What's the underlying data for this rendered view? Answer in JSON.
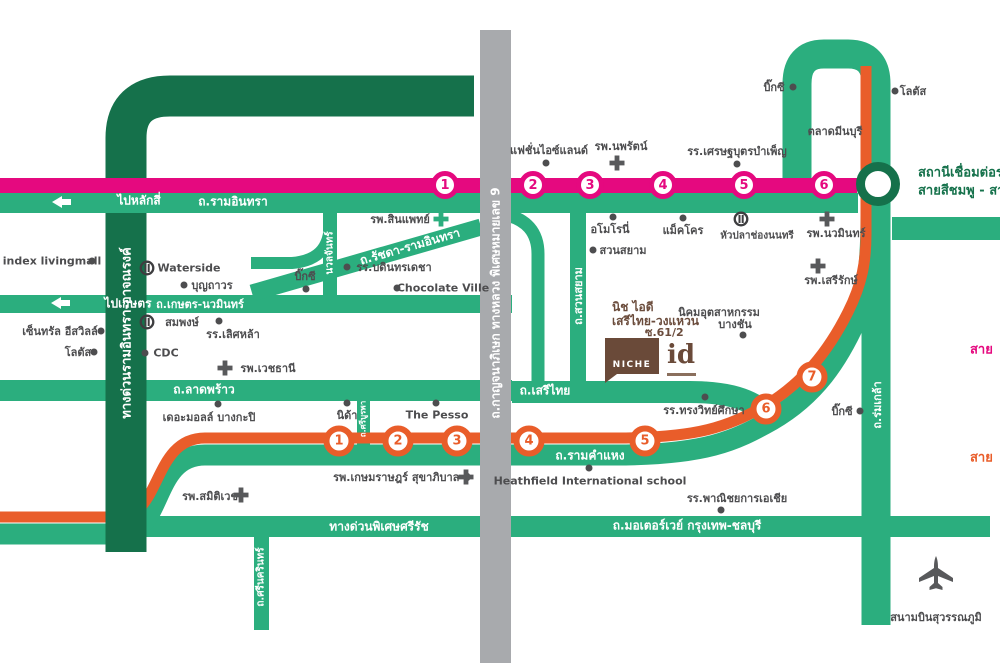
{
  "roads": {
    "ramindra": "ถ.รามอินทรา",
    "to_laksi": "ไปหลักสี่",
    "to_kaset": "ไปเกษตร",
    "kaset_nawamin": "ถ.เกษตร-นวมินทร์",
    "ratchada_ramindra": "ถ.รัชดา-รามอินทรา",
    "nuanchan": "นวลจันทร์",
    "ladprao": "ถ.ลาดพร้าว",
    "serithai": "ถ.เสรีไทย",
    "ramkhamhaeng": "ถ.รามคำแหง",
    "suan_siam": "ถ.สวนสยาม",
    "sri_burapha": "ถ.ศรีบูรพา",
    "kanchanaphisek": "ถ.กาญจนาภิเษก ทางหลวง พิเศษหมายเลข 9",
    "ramindra_expressway": "ทางด่วนรามอินทรา-อาจณรงค์",
    "sirat_expressway": "ทางด่วนพิเศษศรีรัช",
    "motorway": "ถ.มอเตอร์เวย์ กรุงเทพ-ชลบุรี",
    "srinagarindra": "ถ.ศรีนครินทร์",
    "romklao": "ถ.ร่มเกล้า"
  },
  "stations": {
    "pink": [
      "1",
      "2",
      "3",
      "4",
      "5",
      "6"
    ],
    "orange": [
      "1",
      "2",
      "3",
      "4",
      "5",
      "6",
      "7"
    ]
  },
  "interchange": {
    "line1": "สถานีเชื่อมต่อรถ",
    "line2": "สายสีชมพู - สาย"
  },
  "line_labels": {
    "pink_cut": "สาย",
    "orange_cut": "สาย"
  },
  "project": {
    "name_line1": "นิช ไอดี",
    "name_line2": "เสรีไทย-วงแหวน",
    "name_line3": "ซ.61/2",
    "logo": "NICHE",
    "logo_id": "id"
  },
  "pois": {
    "fashion_island": "แฟชั่นไอซ์แลนด์",
    "nopparat_hospital": "รพ.นพรัตน์",
    "setthabut_school": "รร.เศรษฐบุตรบำเพ็ญ",
    "bigc_top": "บิ๊กซี",
    "lotus_top": "โลตัส",
    "minburi_market": "ตลาดมีนบุรี",
    "index_livingmall": "index livingmall",
    "waterside": "Waterside",
    "boonthavorn": "บุญถาวร",
    "central_eastville": "เซ็นทรัล อีสวิลล์",
    "lotus_left": "โลตัส",
    "sompong": "สมพงษ์",
    "lertlah_school": "รร.เลิศหล้า",
    "cdc": "CDC",
    "vejthani_hospital": "รพ.เวชธานี",
    "sinphaet_hospital": "รพ.สินแพทย์",
    "bodindecha_school": "รร.บดินทรเดชา",
    "bigc_mid": "บิ๊กซี",
    "chocolate_ville": "Chocolate Ville",
    "amoroni": "อโมโรนี่",
    "makro": "แม็คโคร",
    "huapla_chongnonsi": "หัวปลาช่องนนทรี",
    "suan_siam_park": "สวนสยาม",
    "bangchan_line1": "นิคมอุตสาหกรรม",
    "bangchan_line2": "บางชัน",
    "nawamin_hospital": "รพ.นวมินทร์",
    "seriruk_hospital": "รพ.เสรีรักษ์",
    "nida": "นิด้า",
    "the_pesso": "The Pesso",
    "the_mall_bangkapi": "เดอะมอลล์ บางกะปิ",
    "kasemrad_hospital": "รพ.เกษมราษฎร์ สุขาภิบาล 3",
    "heathfield": "Heathfield International school",
    "songwit_school": "รร.ทรงวิทย์ศึกษา",
    "panichayakan_asia_school": "รร.พาณิชยการเอเชีย",
    "bigc_bottom": "บิ๊กซี",
    "samitivej_hospital": "รพ.สมิติเวช",
    "suvarnabhumi_airport": "สนามบินสุวรรณภูมิ"
  },
  "colors": {
    "road_green": "#2BAE7E",
    "expressway_dark_green": "#15714B",
    "pink_line": "#E5097F",
    "orange_line": "#E95D2A",
    "ring_road_gray": "#A8AAAD",
    "label_gray": "#4D4D4F",
    "project_brown": "#6A4A39"
  }
}
